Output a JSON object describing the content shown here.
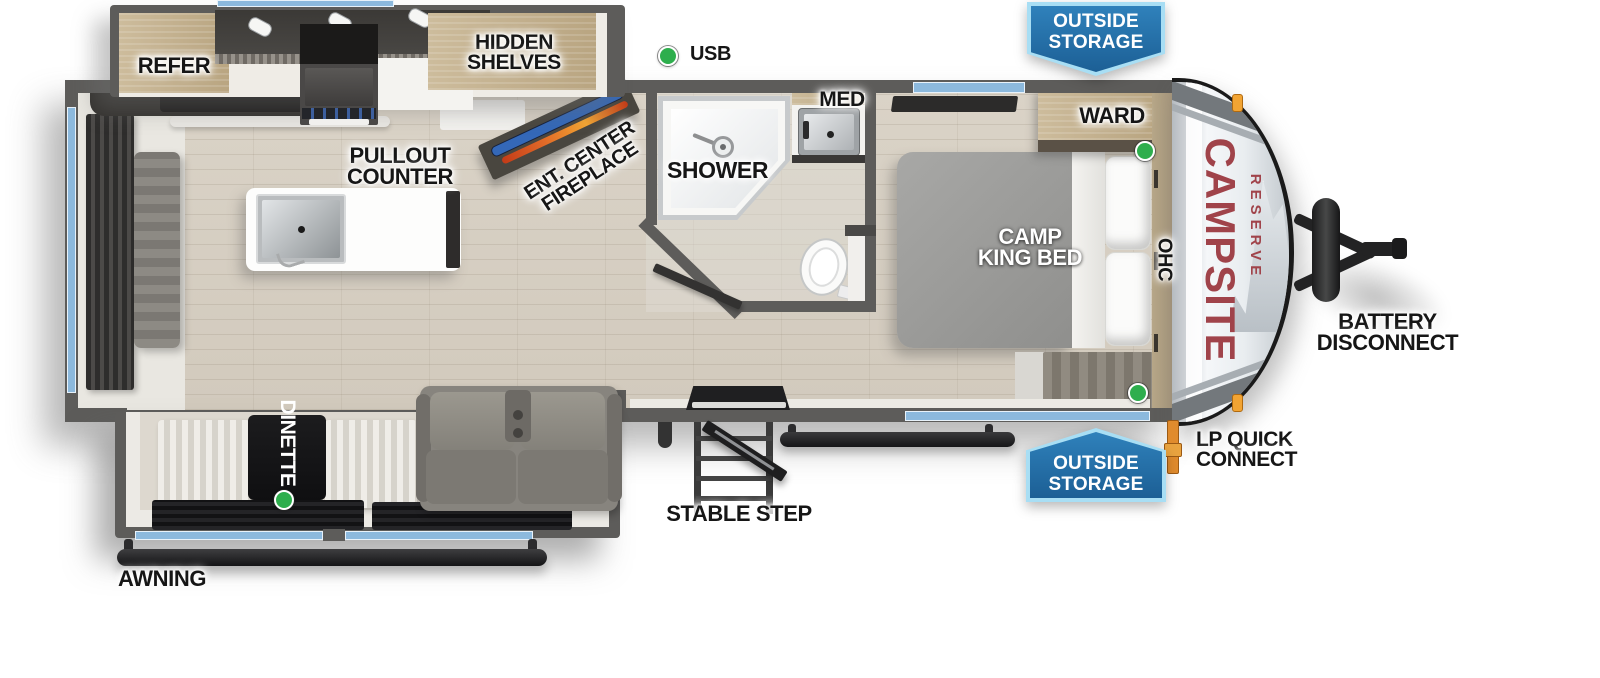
{
  "brand": {
    "name": "CAMPSITE",
    "series": "RESERVE"
  },
  "kitchen": {
    "refer": "REFER",
    "hidden_shelves_line1": "HIDDEN",
    "hidden_shelves_line2": "SHELVES",
    "pullout_line1": "PULLOUT",
    "pullout_line2": "COUNTER",
    "ent_line1": "ENT. CENTER",
    "ent_line2": "FIREPLACE",
    "usb": "USB"
  },
  "bathroom": {
    "shower": "SHOWER",
    "med": "MED"
  },
  "bedroom": {
    "bed_line1": "CAMP",
    "bed_line2": "KING BED",
    "ward": "WARD",
    "ohc": "OHC"
  },
  "living": {
    "dinette": "DINETTE"
  },
  "exterior": {
    "awning": "AWNING",
    "stable_step": "STABLE STEP",
    "outside_storage_line1": "OUTSIDE",
    "outside_storage_line2": "STORAGE",
    "lp_line1": "LP QUICK",
    "lp_line2": "CONNECT",
    "battery_line1": "BATTERY",
    "battery_line2": "DISCONNECT"
  },
  "colors": {
    "wall_gray": "#5d5c5a",
    "floor_wood": "#d6cfc2",
    "window_blue": "#8cb9dd",
    "badge_blue": "#2273ae",
    "badge_border_blue": "#a8def4",
    "indicator_green": "#2eae4d",
    "clearance_orange": "#f2a433",
    "brand_red": "#a0434a",
    "fireplace_orange": "#e06a28",
    "tv_blue": "#3468b8"
  }
}
